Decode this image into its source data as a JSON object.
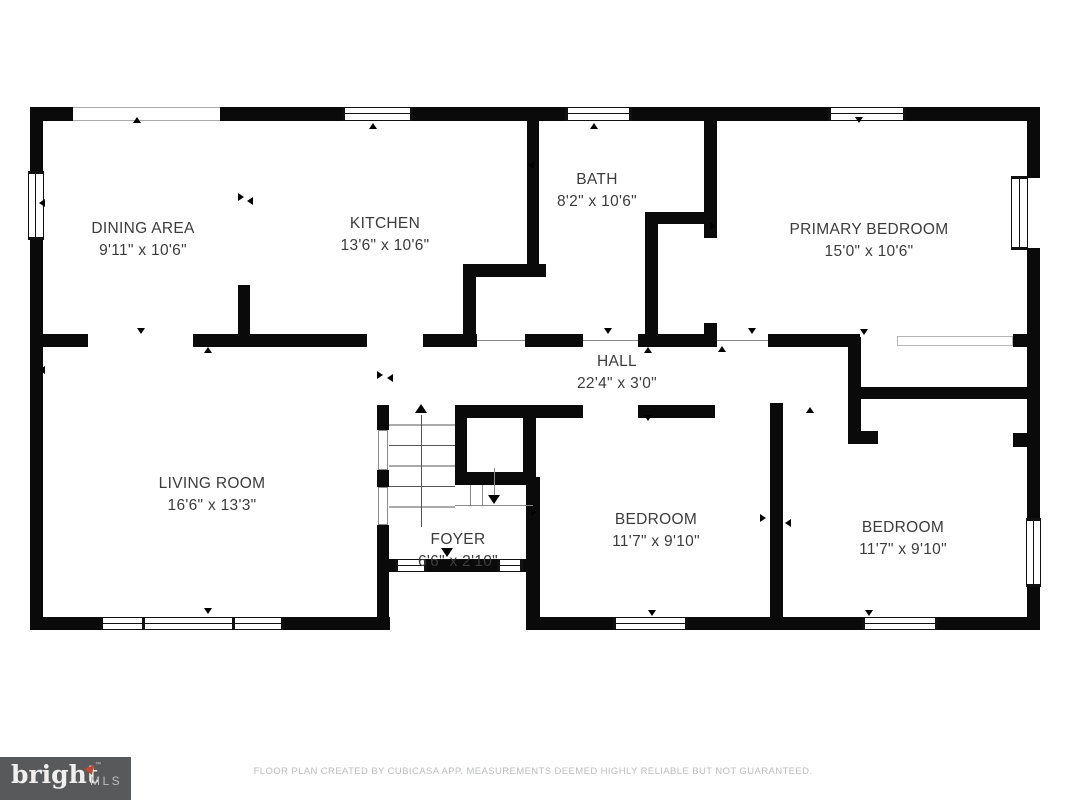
{
  "rooms": {
    "dining": {
      "name": "DINING AREA",
      "dims": "9'11\" x 10'6\""
    },
    "kitchen": {
      "name": "KITCHEN",
      "dims": "13'6\" x 10'6\""
    },
    "bath": {
      "name": "BATH",
      "dims": "8'2\" x 10'6\""
    },
    "primary_bedroom": {
      "name": "PRIMARY BEDROOM",
      "dims": "15'0\" x 10'6\""
    },
    "hall": {
      "name": "HALL",
      "dims": "22'4\" x 3'0\""
    },
    "living_room": {
      "name": "LIVING ROOM",
      "dims": "16'6\" x 13'3\""
    },
    "foyer": {
      "name": "FOYER",
      "dims": "6'6\" x 2'10\""
    },
    "bedroom_middle": {
      "name": "BEDROOM",
      "dims": "11'7\" x 9'10\""
    },
    "bedroom_right": {
      "name": "BEDROOM",
      "dims": "11'7\" x 9'10\""
    }
  },
  "footer": {
    "logo_text": "bright",
    "logo_mls": "MLS",
    "logo_tm": "™",
    "disclaimer": "FLOOR PLAN CREATED BY CUBICASA APP. MEASUREMENTS DEEMED HIGHLY RELIABLE BUT NOT GUARANTEED."
  },
  "colors": {
    "wall": "#0a0a0a",
    "logo_bg": "#58595b",
    "logo_accent": "#bf4b32",
    "label_text": "#3c3c3c",
    "muted_text": "#bbbcbe"
  }
}
